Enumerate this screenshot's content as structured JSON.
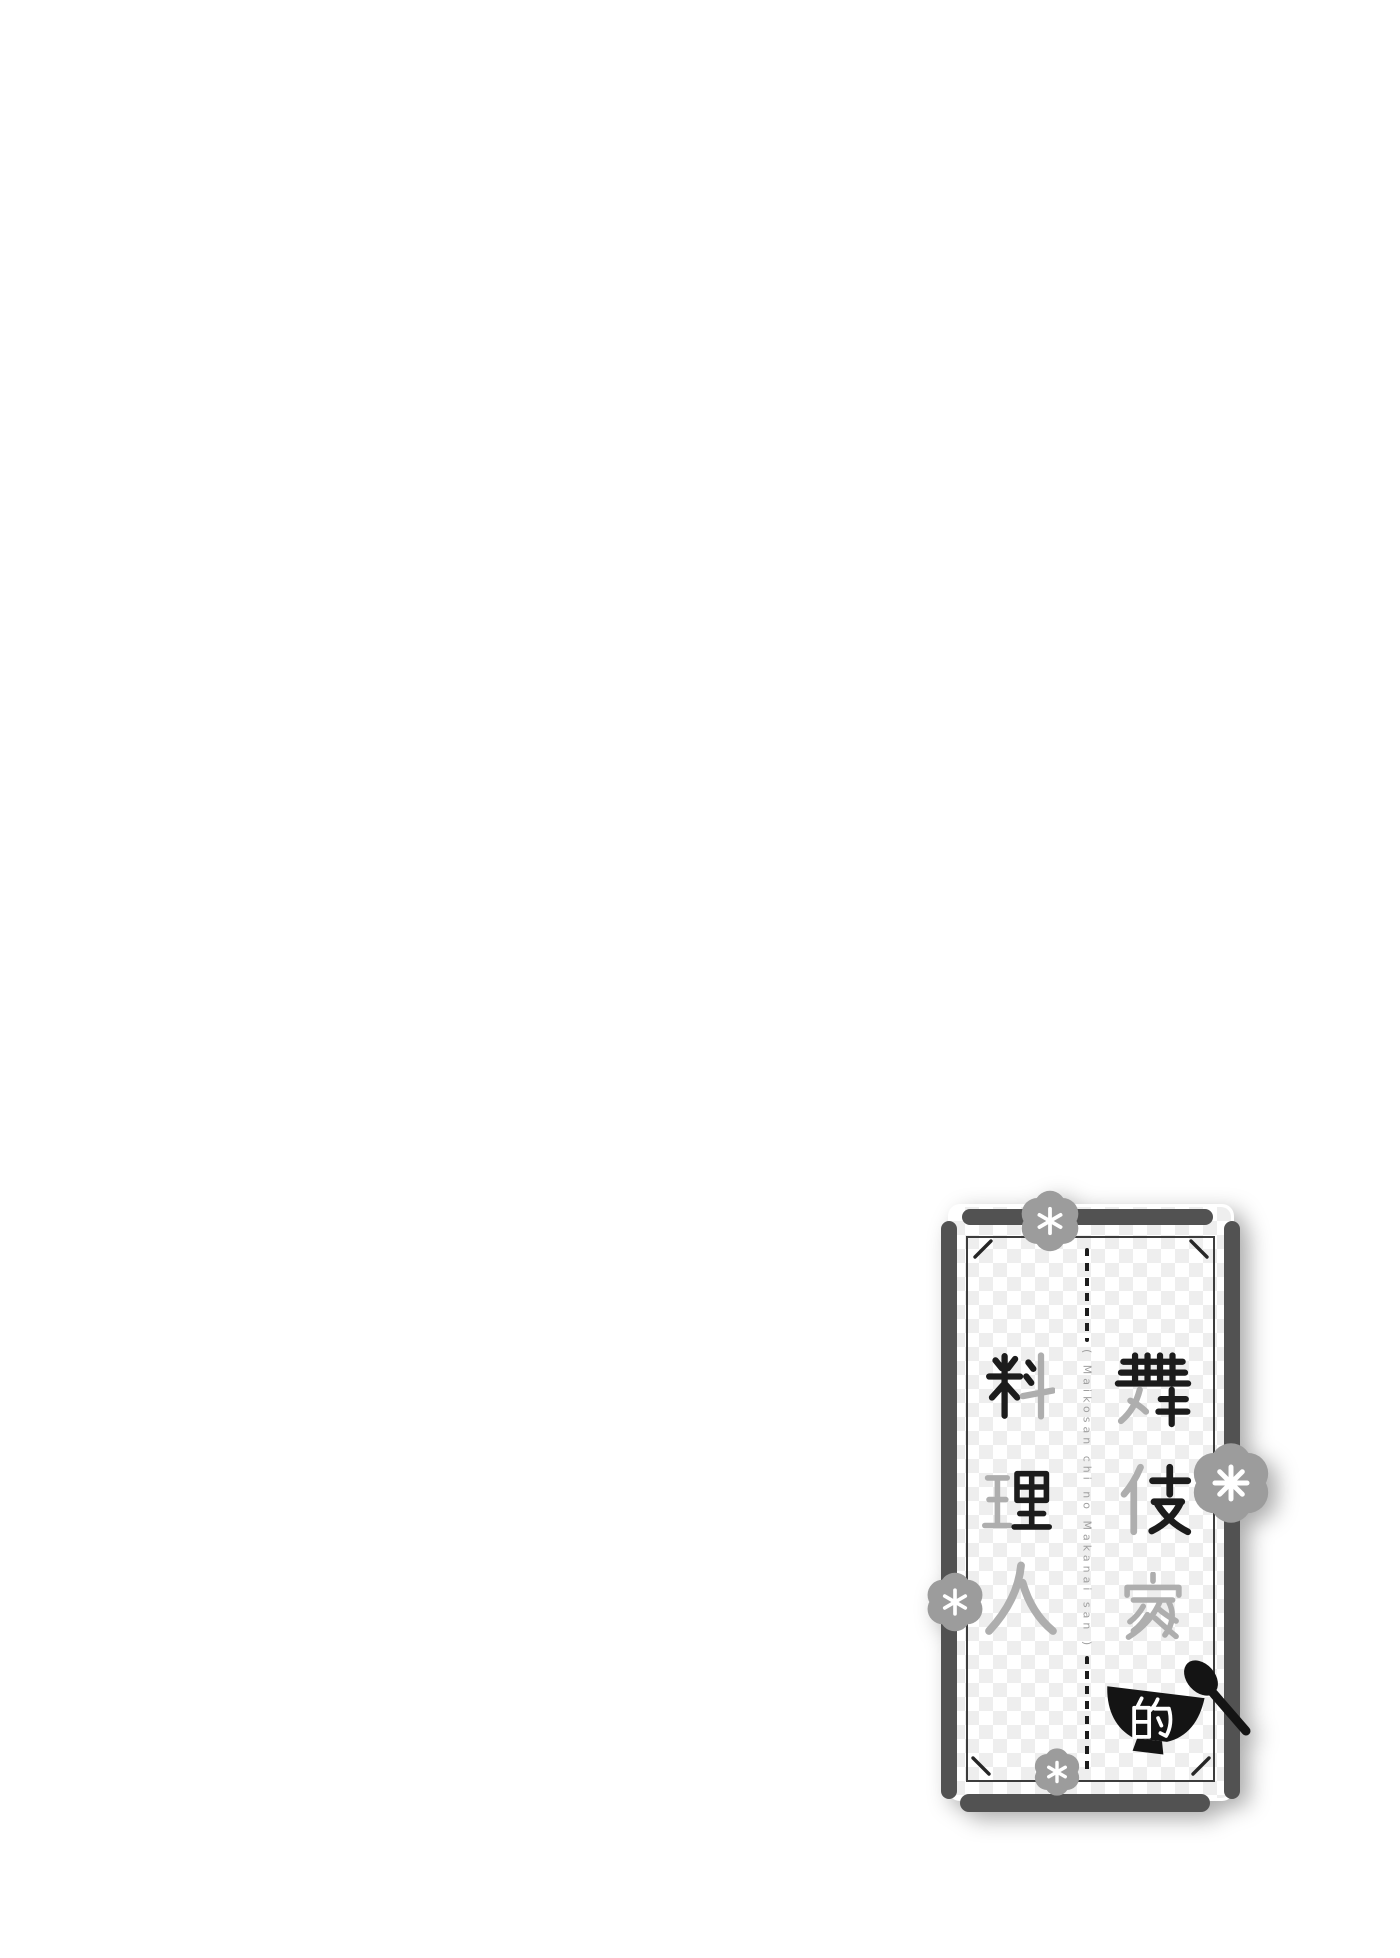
{
  "page": {
    "background_color": "#ffffff"
  },
  "logo": {
    "title": "舞伎家的料理人",
    "title_chars": [
      "舞",
      "伎",
      "家",
      "的",
      "料",
      "理",
      "人"
    ],
    "romaji_vertical": "( Maikosan chi no Makanai san )",
    "icons": {
      "flower": "plum-blossom-icon",
      "bowl": "rice-bowl-icon",
      "spoon": "spoon-icon"
    },
    "colors": {
      "ink_black": "#1c1c1c",
      "ink_gray": "#aeaeae",
      "frame_gray": "#525252",
      "flower_gray": "#9c9c9c",
      "checker_gray": "#ededed",
      "romaji_gray": "#9f9f9f"
    }
  }
}
